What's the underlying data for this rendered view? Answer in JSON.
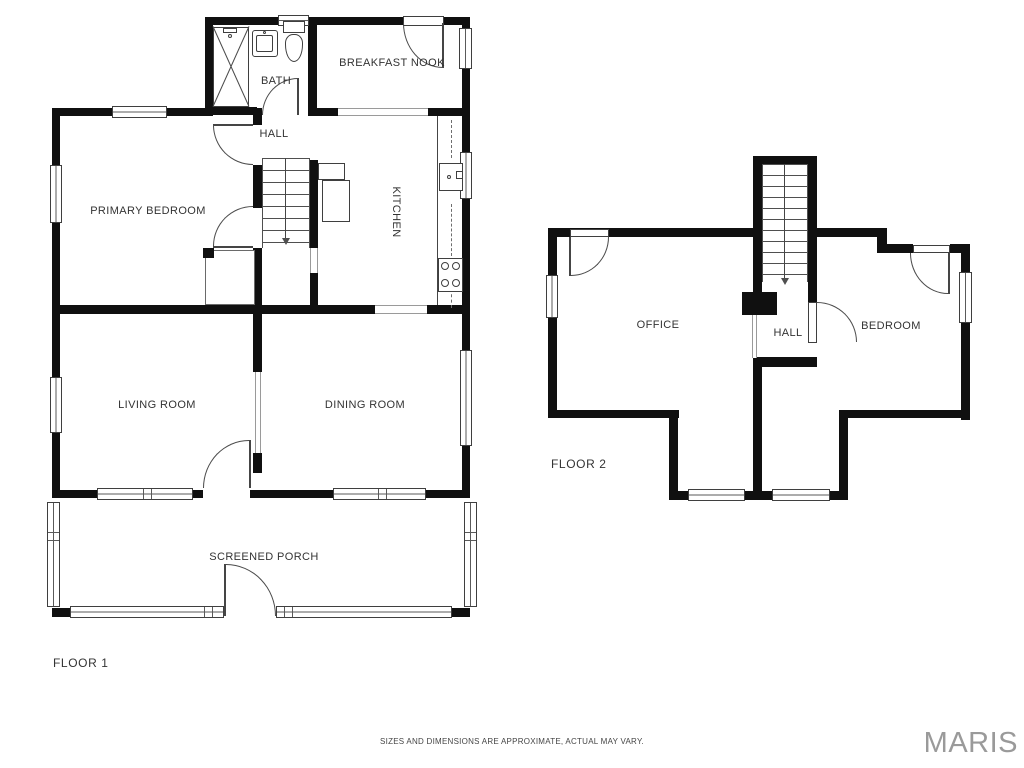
{
  "page": {
    "disclaimer": "SIZES AND DIMENSIONS ARE APPROXIMATE, ACTUAL MAY VARY.",
    "watermark": "MARIS"
  },
  "colors": {
    "wall": "#101010",
    "line": "#4a4a4a",
    "text": "#333333",
    "watermark": "#9a9a9a",
    "background": "#ffffff"
  },
  "floor1": {
    "label": "FLOOR 1",
    "rooms": {
      "bath": "BATH",
      "breakfast_nook": "BREAKFAST NOOK",
      "hall": "HALL",
      "primary_bedroom": "PRIMARY BEDROOM",
      "kitchen": "KITCHEN",
      "living_room": "LIVING ROOM",
      "dining_room": "DINING ROOM",
      "screened_porch": "SCREENED PORCH"
    }
  },
  "floor2": {
    "label": "FLOOR 2",
    "rooms": {
      "office": "OFFICE",
      "hall": "HALL",
      "bedroom": "BEDROOM"
    }
  }
}
